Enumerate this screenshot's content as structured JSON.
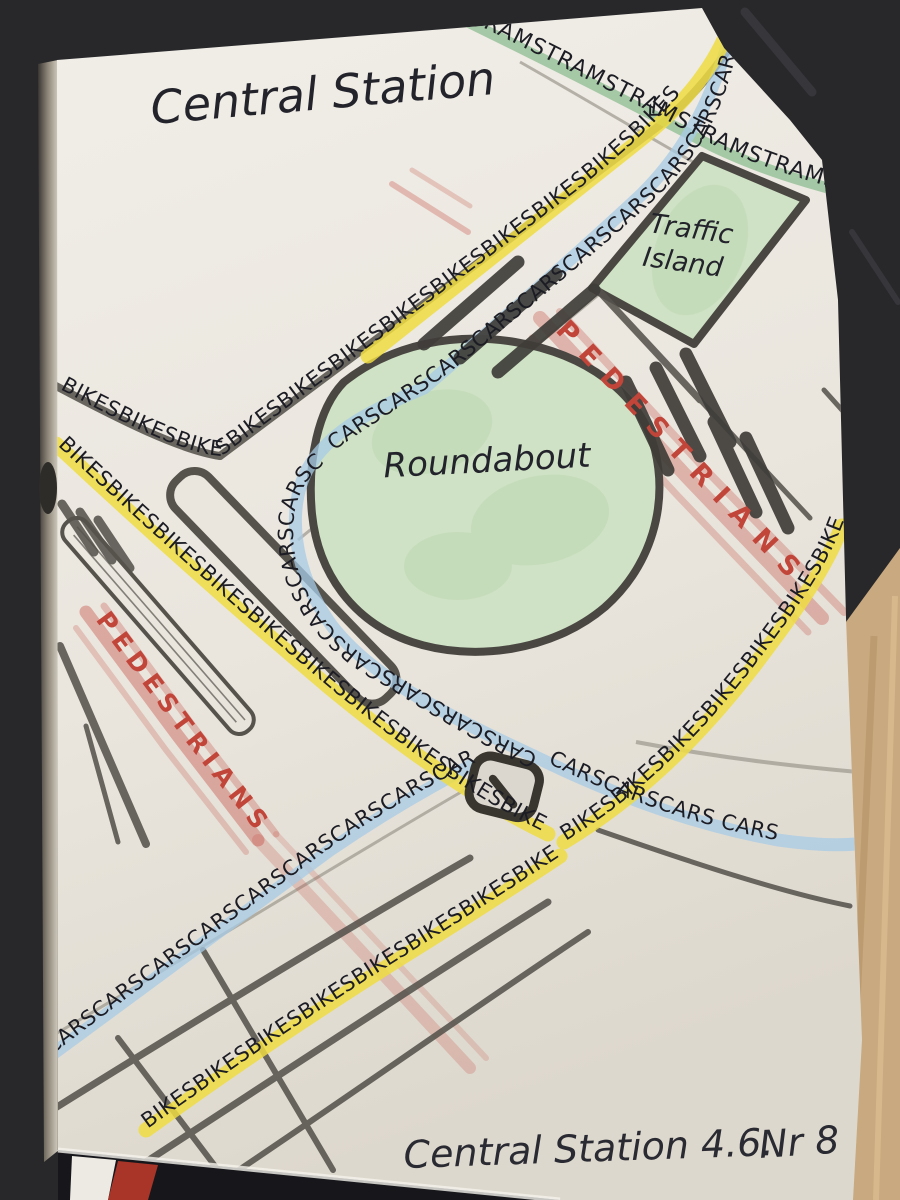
{
  "notebook": {
    "title": "Central Station",
    "footer_caption": "Central Station 4.6.",
    "footer_page_number": "Nr 8"
  },
  "map": {
    "roundabout_label": "Roundabout",
    "traffic_island_label_line1": "Traffic",
    "traffic_island_label_line2": "Island",
    "routes": {
      "trams": {
        "label": "TRAMSTRAMSTRAMSTRAMSTRAMSTRAMS"
      },
      "bikes_main_diagonal": {
        "label": "BIKESBIKESBIKESBIKESBIKESBIKESBIKESBIKESBIKESBIKESBIKESBIKES"
      },
      "bikes_left": {
        "label": "BIKESBIKESBIKESBIKESBIKESBIKESBIKESBIKESBIKESBIKES"
      },
      "bikes_bottom": {
        "label": "BIKESBIKESBIKESBIKESBIKESBIKESBIKESBIKES"
      },
      "bikes_right": {
        "label": "BIKESBIKESBIKESBIKESBIKESBIKESBIKES"
      },
      "cars_corridor": {
        "label": "CARSCARSCARSCARSCARSCARSCARSCARSCARSCARS"
      },
      "cars_roundabout": {
        "label": "CARSCARSCARSCARSCARSCARSCARSCARS"
      },
      "cars_right_exit": {
        "label": "CARSCARSCARS CARS"
      },
      "cars_bottom_left": {
        "label": "CARSCARSCARSCARSCARSCARSCARSCARSCARS"
      },
      "pedestrians_right": {
        "label": "PEDESTRIANS"
      },
      "pedestrians_left": {
        "label": "PEDESTRIANS"
      }
    }
  },
  "colors": {
    "bike_yellow": "#eedc42",
    "car_blue": "#a7cbe5",
    "tram_green": "#8cbc90",
    "pedestrian_red": "#c2453a",
    "ink": "#1c1c24",
    "road_gray": "#56534d",
    "marker_dark": "#3f3d39",
    "outline_dark": "#4a4742",
    "area_green": "#cfe2c5"
  }
}
